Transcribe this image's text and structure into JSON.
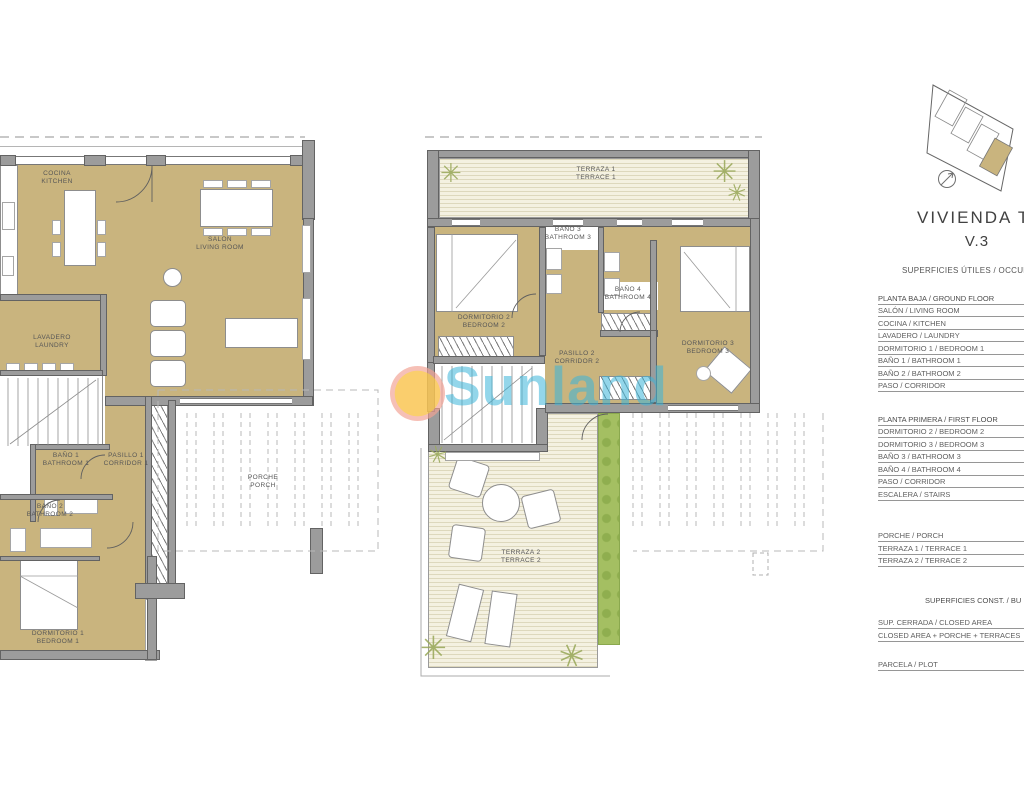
{
  "watermark": {
    "text": "Sunland"
  },
  "panel": {
    "title_line1": "VIVIENDA TIPO",
    "title_line2": "V.3",
    "section_useful_header": "SUPERFICIES ÚTILES / OCCUPIA",
    "groups": [
      {
        "header": "PLANTA BAJA / GROUND FLOOR",
        "rows": [
          "SALÓN / LIVING ROOM",
          "COCINA / KITCHEN",
          "LAVADERO / LAUNDRY",
          "DORMITORIO 1 /  BEDROOM 1",
          "BAÑO 1 / BATHROOM 1",
          "BAÑO 2 / BATHROOM 2",
          "PASO / CORRIDOR"
        ]
      },
      {
        "header": "PLANTA PRIMERA / FIRST FLOOR",
        "rows": [
          "DORMITORIO 2 / BEDROOM 2",
          "DORMITORIO 3 / BEDROOM 3",
          "BAÑO 3 / BATHROOM 3",
          "BAÑO 4 / BATHROOM 4",
          "PASO / CORRIDOR",
          "ESCALERA / STAIRS"
        ]
      },
      {
        "header": "",
        "rows": [
          "PORCHE / PORCH",
          "TERRAZA 1 / TERRACE 1",
          "TERRAZA 2 / TERRACE 2"
        ]
      },
      {
        "header": "SUPERFICIES CONST. / BU",
        "header_align": "right",
        "rows": [
          "SUP. CERRADA / CLOSED AREA",
          "CLOSED AREA + PORCHE + TERRACES"
        ]
      },
      {
        "header": "",
        "rows": [
          "PARCELA / PLOT"
        ]
      }
    ]
  },
  "plans": {
    "ground": {
      "labels": {
        "cocina": {
          "l1": "COCINA",
          "l2": "KITCHEN"
        },
        "salon": {
          "l1": "SALON",
          "l2": "LIVING ROOM"
        },
        "lavadero": {
          "l1": "LAVADERO",
          "l2": "LAUNDRY"
        },
        "bano1": {
          "l1": "BAÑO 1",
          "l2": "BATHROOM 1"
        },
        "pasillo1": {
          "l1": "PASILLO 1",
          "l2": "CORRIDOR 1"
        },
        "bano2": {
          "l1": "BAÑO 2",
          "l2": "BATHROOM 2"
        },
        "dormitorio1": {
          "l1": "DORMITORIO 1",
          "l2": "BEDROOM 1"
        },
        "porche": {
          "l1": "PORCHE",
          "l2": "PORCH"
        }
      }
    },
    "first": {
      "labels": {
        "terraza1": {
          "l1": "TERRAZA 1",
          "l2": "TERRACE 1"
        },
        "bano3": {
          "l1": "BAÑO 3",
          "l2": "BATHROOM 3"
        },
        "dormitorio2": {
          "l1": "DORMITORIO 2",
          "l2": "BEDROOM 2"
        },
        "bano4": {
          "l1": "BAÑO 4",
          "l2": "BATHROOM 4"
        },
        "pasillo2": {
          "l1": "PASILLO 2",
          "l2": "CORRIDOR 2"
        },
        "dormitorio3": {
          "l1": "DORMITORIO 3",
          "l2": "BEDROOM 3"
        },
        "terraza2": {
          "l1": "TERRAZA 2",
          "l2": "TERRACE 2"
        }
      }
    }
  },
  "icons": {
    "palm_glyph": "✳"
  },
  "colors": {
    "room_fill": "#c9b47e",
    "wall": "#9c9c9c",
    "deck": "#f4f1e1",
    "hedge": "#a4bf62",
    "watermark_text": "#3ab5d8",
    "watermark_sun": "#f9c553",
    "watermark_ring": "#f2a294"
  }
}
